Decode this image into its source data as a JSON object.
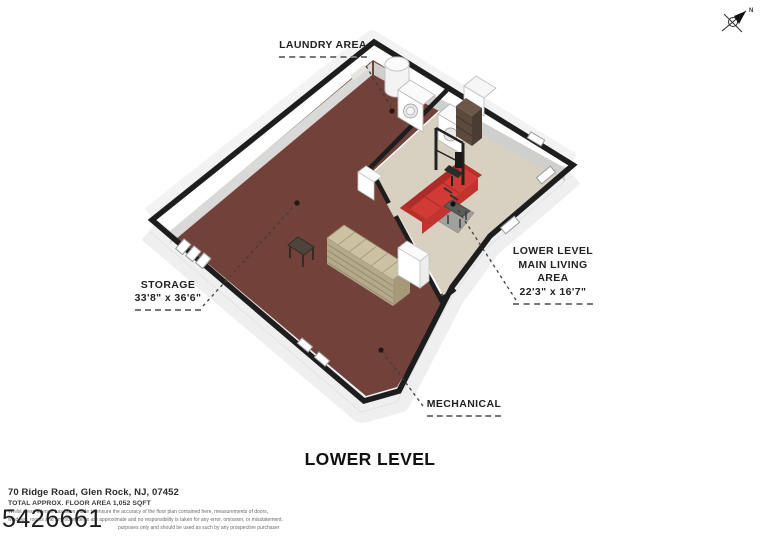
{
  "compass": {
    "north_label": "N"
  },
  "labels": {
    "laundry": "LAUNDRY AREA",
    "storage_name": "STORAGE",
    "storage_dims": "33'8\" x 36'6\"",
    "living_line1": "LOWER LEVEL",
    "living_line2": "MAIN LIVING",
    "living_line3": "AREA",
    "living_dims": "22'3\" x 16'7\"",
    "mechanical": "MECHANICAL"
  },
  "title": "LOWER LEVEL",
  "footer": {
    "address": "70 Ridge Road, Glen Rock, NJ, 07452",
    "floor_area": "TOTAL APPROX. FLOOR AREA 1,052 SQFT",
    "disclaimer1": "Whilst every attempt has been made to ensure the accuracy of the floor plan contained here, measurements of doors,",
    "disclaimer2": "windows, rooms and any other items are approximate and no responsibility is taken for any error, omission, or misstatement.",
    "disclaimer3": "purposes only and should be used as such by any prospective purchaser",
    "watermark": "5426661"
  },
  "colors": {
    "storage_floor": "#72413a",
    "living_floor": "#d8d1c2",
    "wall_top": "#1d1d1d",
    "sofa": "#d23b35",
    "rug": "#a0a09c",
    "stairs": "#cdc1a4"
  }
}
